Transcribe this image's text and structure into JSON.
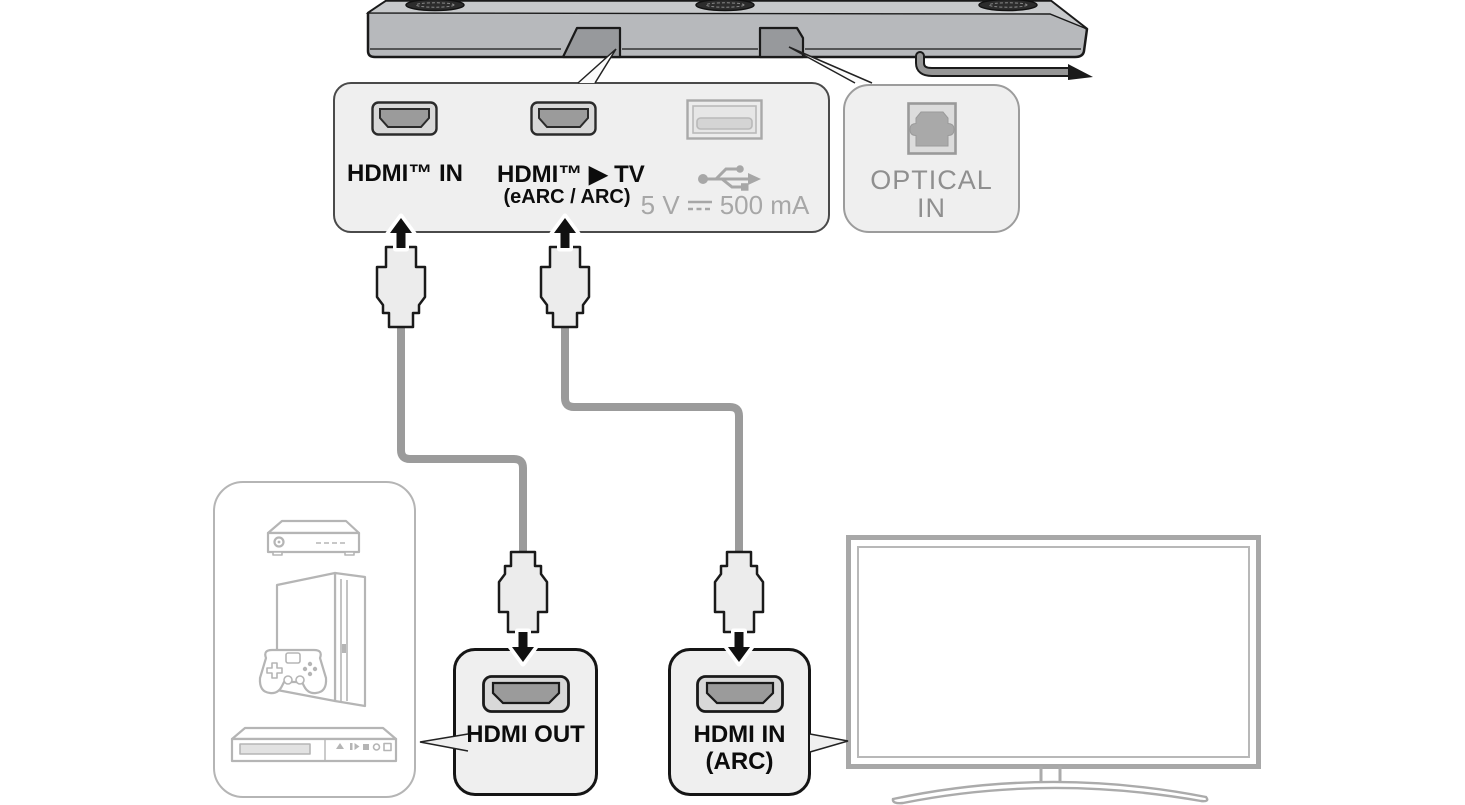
{
  "diagram": {
    "type": "soundbar-connection-diagram",
    "soundbar_ports_panel": {
      "hdmi_in_label": "HDMI™ IN",
      "hdmi_tv_label": "HDMI™ ▶ TV",
      "hdmi_tv_sublabel": "(eARC / ARC)",
      "usb_rating": {
        "prefix": "5 V",
        "suffix": "500 mA"
      }
    },
    "optical_panel": {
      "line1": "OPTICAL",
      "line2": "IN"
    },
    "hdmi_out_panel": {
      "label": "HDMI OUT"
    },
    "hdmi_in_arc_panel": {
      "line1": "HDMI IN",
      "line2": "(ARC)"
    },
    "icons": {
      "ports": [
        "hdmi-port-icon",
        "hdmi-port-icon",
        "usb-port-icon",
        "optical-port-icon"
      ],
      "symbols": [
        "usb-trident-icon",
        "dc-voltage-icon",
        "arrow-up-icon",
        "arrow-down-icon"
      ],
      "illustrations": [
        "soundbar",
        "hdmi-plug",
        "hdmi-cable",
        "power-cable",
        "set-top-box",
        "game-console",
        "game-controller",
        "disc-player",
        "tv"
      ]
    },
    "colors": {
      "panel_fill": "#efefef",
      "panel_border_dark": "#4a4a4a",
      "panel_border_black": "#151515",
      "panel_border_gray": "#9c9c9c",
      "gray_text": "#a7a7a7",
      "optical_text": "#8f8f8f",
      "cable_gray": "#9b9b9b",
      "device_outline": "#b5b5b5",
      "tv_outline": "#a8a8a8",
      "soundbar_top": "#c7c9cb",
      "soundbar_front": "#b7b9bc",
      "port_inner_gray": "#9b9b9b",
      "arrow_black": "#111111"
    }
  }
}
